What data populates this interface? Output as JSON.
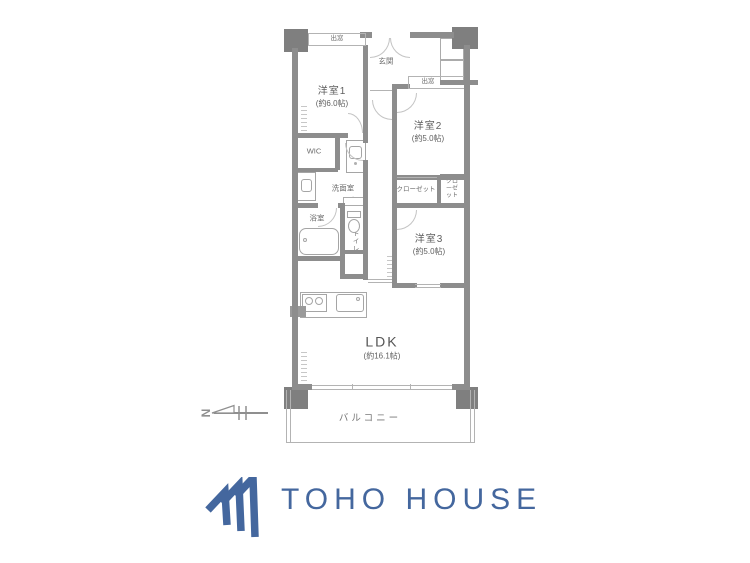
{
  "colors": {
    "wall": "#8d8d8d",
    "pillar": "#7f7f7f",
    "thin_line": "#b3b3b3",
    "label_text": "#5f5f5f",
    "logo_blue": "#44679e"
  },
  "floorplan": {
    "rooms": [
      {
        "label": "洋室1",
        "size": "(約6.0帖)"
      },
      {
        "label": "洋室2",
        "size": "(約5.0帖)"
      },
      {
        "label": "洋室3",
        "size": "(約5.0帖)"
      },
      {
        "label": "LDK",
        "size": "(約16.1帖)"
      }
    ],
    "labels": {
      "entrance": "玄関",
      "bay_window_1": "出窓",
      "bay_window_2": "出窓",
      "meter_box": "MB",
      "trunk_room": "TR",
      "walk_in_closet": "WIC",
      "washroom": "洗面室",
      "bathroom": "浴室",
      "toilet": "トイレ",
      "shelf": "棚",
      "refrigerator": "R",
      "closet_1": "クローゼット",
      "closet_2": "クローゼット",
      "balcony": "バルコニー"
    },
    "compass_label": "N"
  },
  "logo": {
    "text": "TOHO HOUSE"
  }
}
